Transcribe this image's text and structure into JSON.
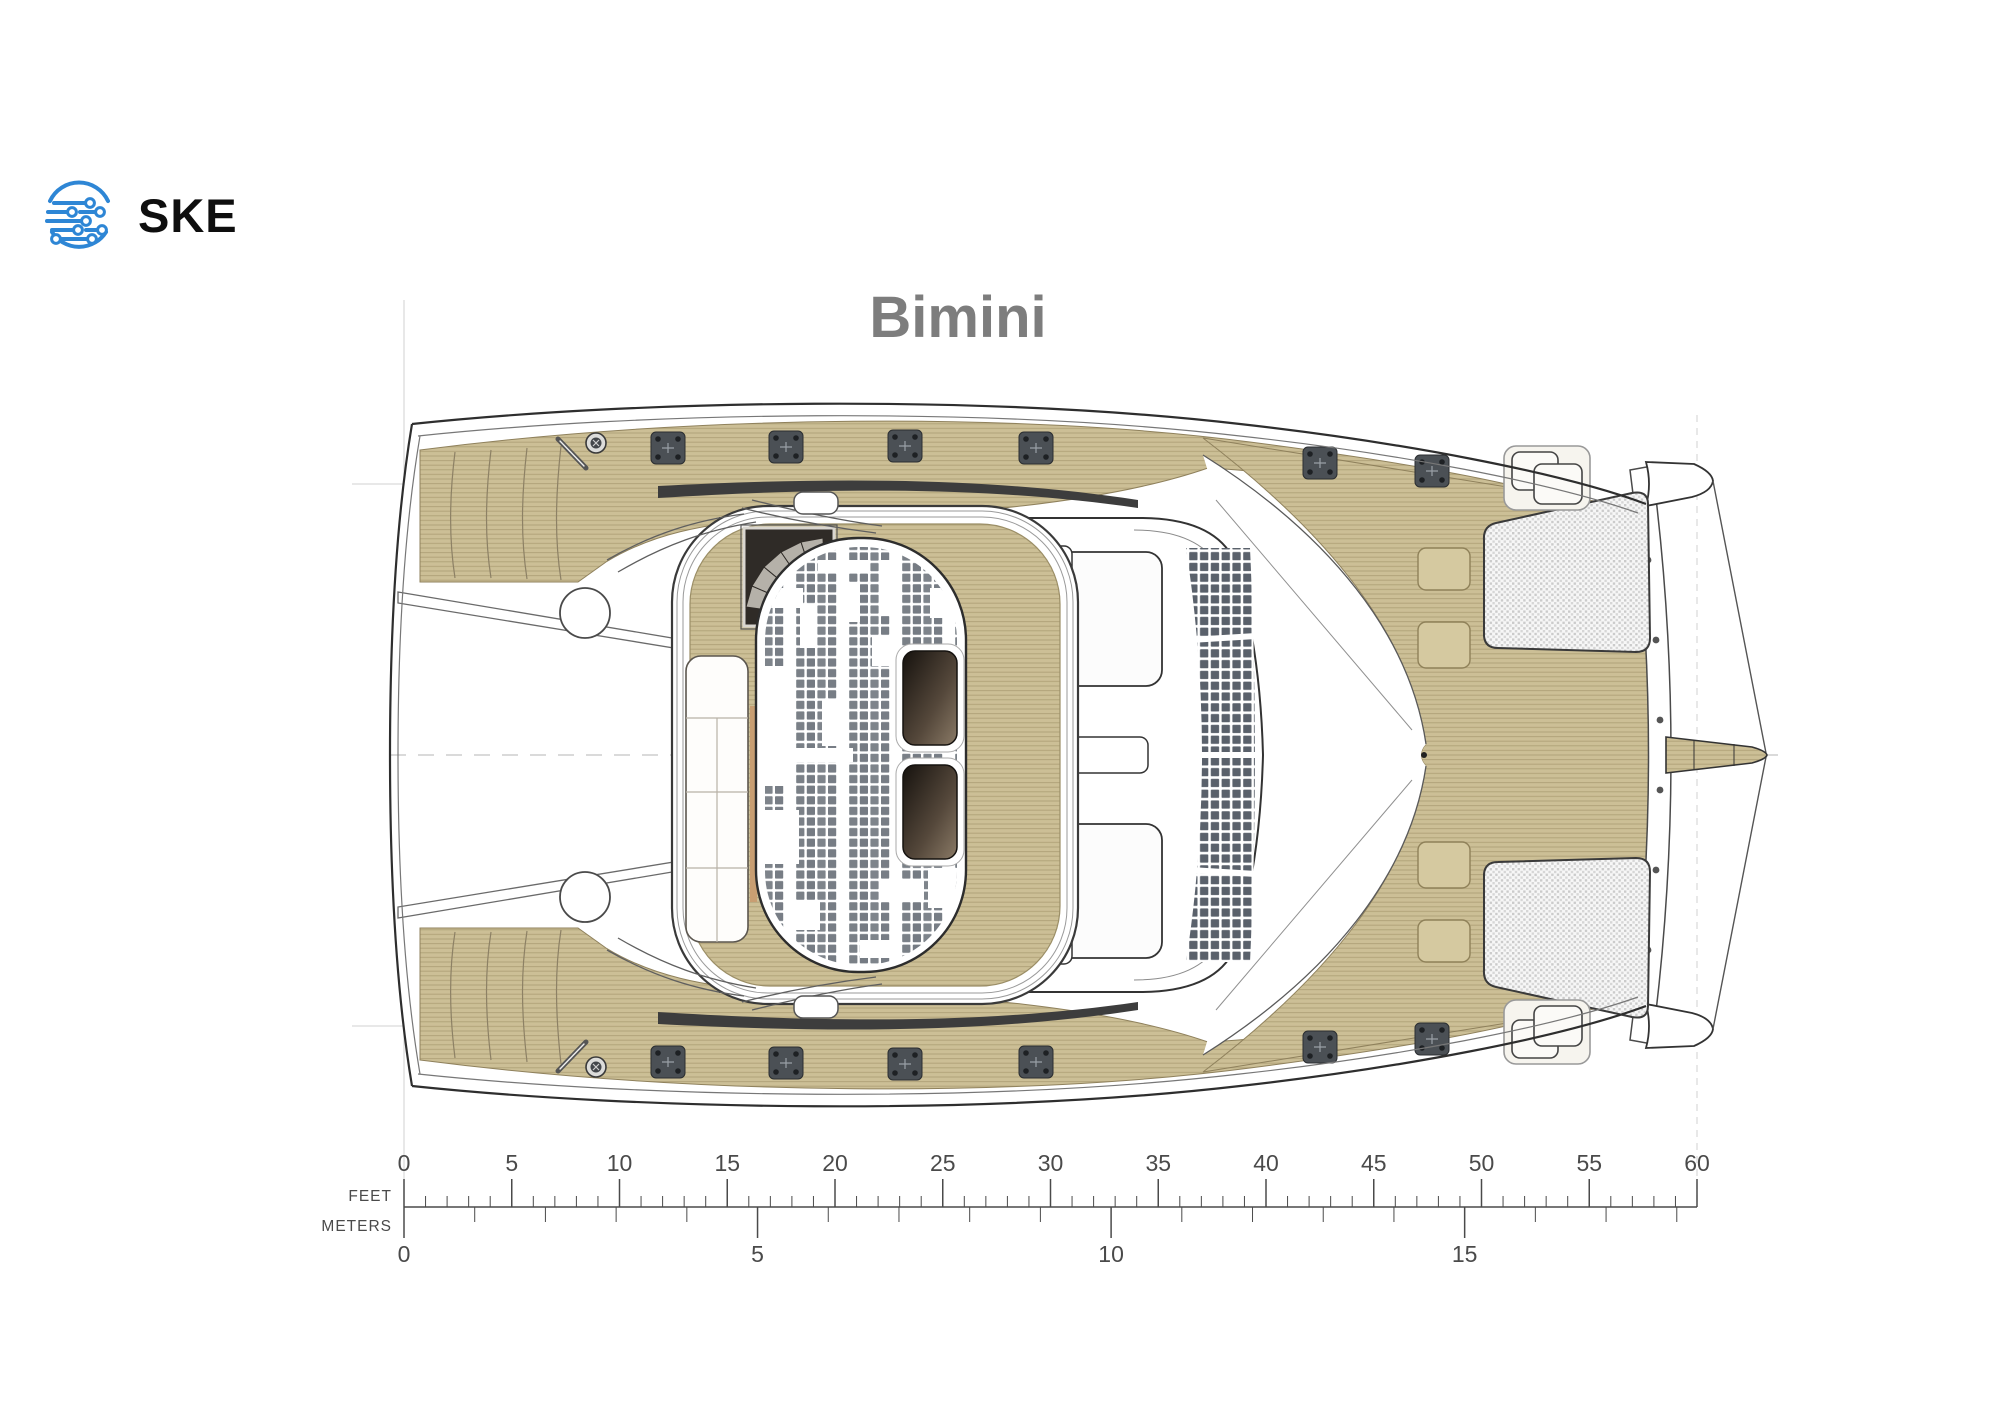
{
  "brand": {
    "logo_text": "SKE",
    "logo_icon": "circuit-globe-icon",
    "logo_color": "#2e86d5",
    "text_color": "#0e0e0e"
  },
  "title": {
    "text": "Bimini",
    "color": "#7d7d7d"
  },
  "diagram": {
    "name": "catamaran-deck-plan",
    "view": "top-down",
    "deck_label": "Bimini",
    "features": [
      "teak-side-decks",
      "stern-steps",
      "flybridge",
      "spiral-staircase",
      "sun-lounger",
      "solar-panel-hardtop",
      "skylights",
      "coachroof",
      "bow-trampolines",
      "anchor-platform",
      "bowsprit",
      "deck-hatches",
      "cleats",
      "winches"
    ],
    "colors": {
      "teak": "#ccbf96",
      "teak_line": "#a89a70",
      "solar_cell": "#7a8087",
      "solar_cell_dark": "#5a616b",
      "trampoline_mesh": "#cccccc",
      "hull_stroke": "#2e2e2e",
      "hardware_gray": "#4b5055",
      "skylight_dark": "#16120e"
    }
  },
  "scale_bar": {
    "feet": {
      "label": "FEET",
      "tick_labels": [
        "0",
        "5",
        "10",
        "15",
        "20",
        "25",
        "30",
        "35",
        "40",
        "45",
        "50",
        "55",
        "60"
      ],
      "major_interval": 5,
      "minor_interval": 1,
      "max": 60
    },
    "meters": {
      "label": "METERS",
      "tick_labels": [
        "0",
        "5",
        "10",
        "15"
      ],
      "major_interval": 5,
      "minor_interval": 1,
      "max": 18
    },
    "color": "#4a4a4a"
  }
}
